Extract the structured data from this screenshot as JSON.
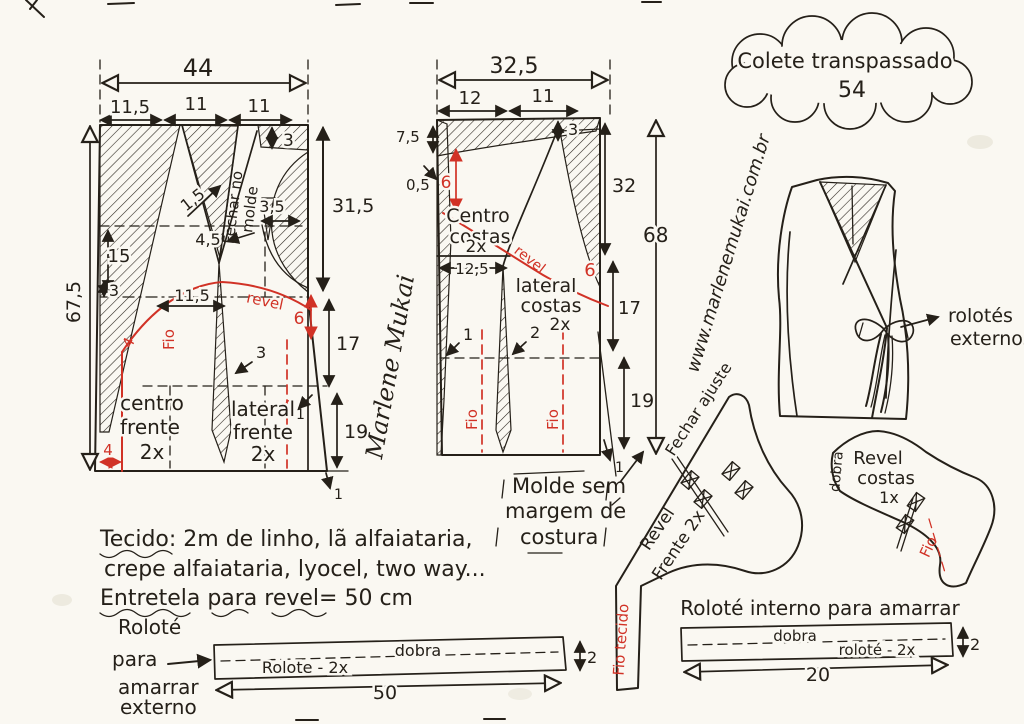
{
  "colors": {
    "ink": "#252019",
    "red": "#d13226",
    "paper": "#faf8f2"
  },
  "cloud": {
    "title": "Colete transpassado",
    "size": "54"
  },
  "website": "www.marlenemukai.com.br",
  "signature": "Marlene Mukai",
  "front": {
    "total_width": "44",
    "seg1": "11,5",
    "seg2": "11",
    "seg3": "11",
    "height": "67,5",
    "d3_top": "3",
    "d31_5": "31,5",
    "d3_5": "3,5",
    "d1_5": "1,5",
    "d4_5": "4,5",
    "d15": "15",
    "d3_left": "3",
    "d11_5": "11,5",
    "d6": "6",
    "d17": "17",
    "d19": "19",
    "d4_curve": "4",
    "d4_bottom": "4",
    "d3_dart": "3",
    "d1_side": "1",
    "d1_bottom": "1",
    "fechar_line1": "Fechar no",
    "fechar_line2": "molde",
    "revel": "revel",
    "fio": "Fio",
    "fio2": "Fio",
    "centro": [
      "centro",
      "frente",
      "2x"
    ],
    "lateral": [
      "lateral",
      "frente",
      "2x"
    ]
  },
  "back": {
    "total_width": "32,5",
    "seg1": "12",
    "seg2": "11",
    "d7_5": "7,5",
    "d0_5": "0,5",
    "d6_top": "6",
    "d3": "3",
    "d32": "32",
    "d68": "68",
    "d12_5": "12,5",
    "d6_revel": "6",
    "d17": "17",
    "d19": "19",
    "d1_dart": "1",
    "d2_dart": "2",
    "d1_bottom": "1",
    "centro": [
      "Centro",
      "costas",
      "2x"
    ],
    "lateral": [
      "lateral",
      "costas",
      "2x"
    ],
    "revel": "revel",
    "fio_left": "Fio",
    "fio_right": "Fio"
  },
  "molde_note": [
    "Molde sem",
    "margem de",
    "costura"
  ],
  "fabric_note": {
    "line1": "Tecido: 2m  de linho, lã alfaiataria,",
    "line2": "crepe alfaiataria, lyocel, two way...",
    "line3": "Entretela para revel= 50 cm"
  },
  "vest": {
    "label_line1": "rolotés",
    "label_line2": "externos"
  },
  "revel_frente": {
    "fechar_ajuste": "Fechar ajuste",
    "label_line1": "Revel",
    "label_line2": "Frente 2x",
    "fio_tecido": "Fio tecido"
  },
  "revel_costas": {
    "label": [
      "Revel",
      "costas",
      "1x"
    ],
    "dobra": "dobra",
    "fio": "Fio"
  },
  "rolote_externo": {
    "label": [
      "Roloté",
      "para",
      "amarrar",
      "externo"
    ],
    "dobra": "dobra",
    "piece_label": "Rolote - 2x",
    "width": "50",
    "height": "2"
  },
  "rolote_interno": {
    "title": "Roloté interno para amarrar",
    "dobra": "dobra",
    "piece_label": "roloté - 2x",
    "width": "20",
    "height": "2"
  }
}
